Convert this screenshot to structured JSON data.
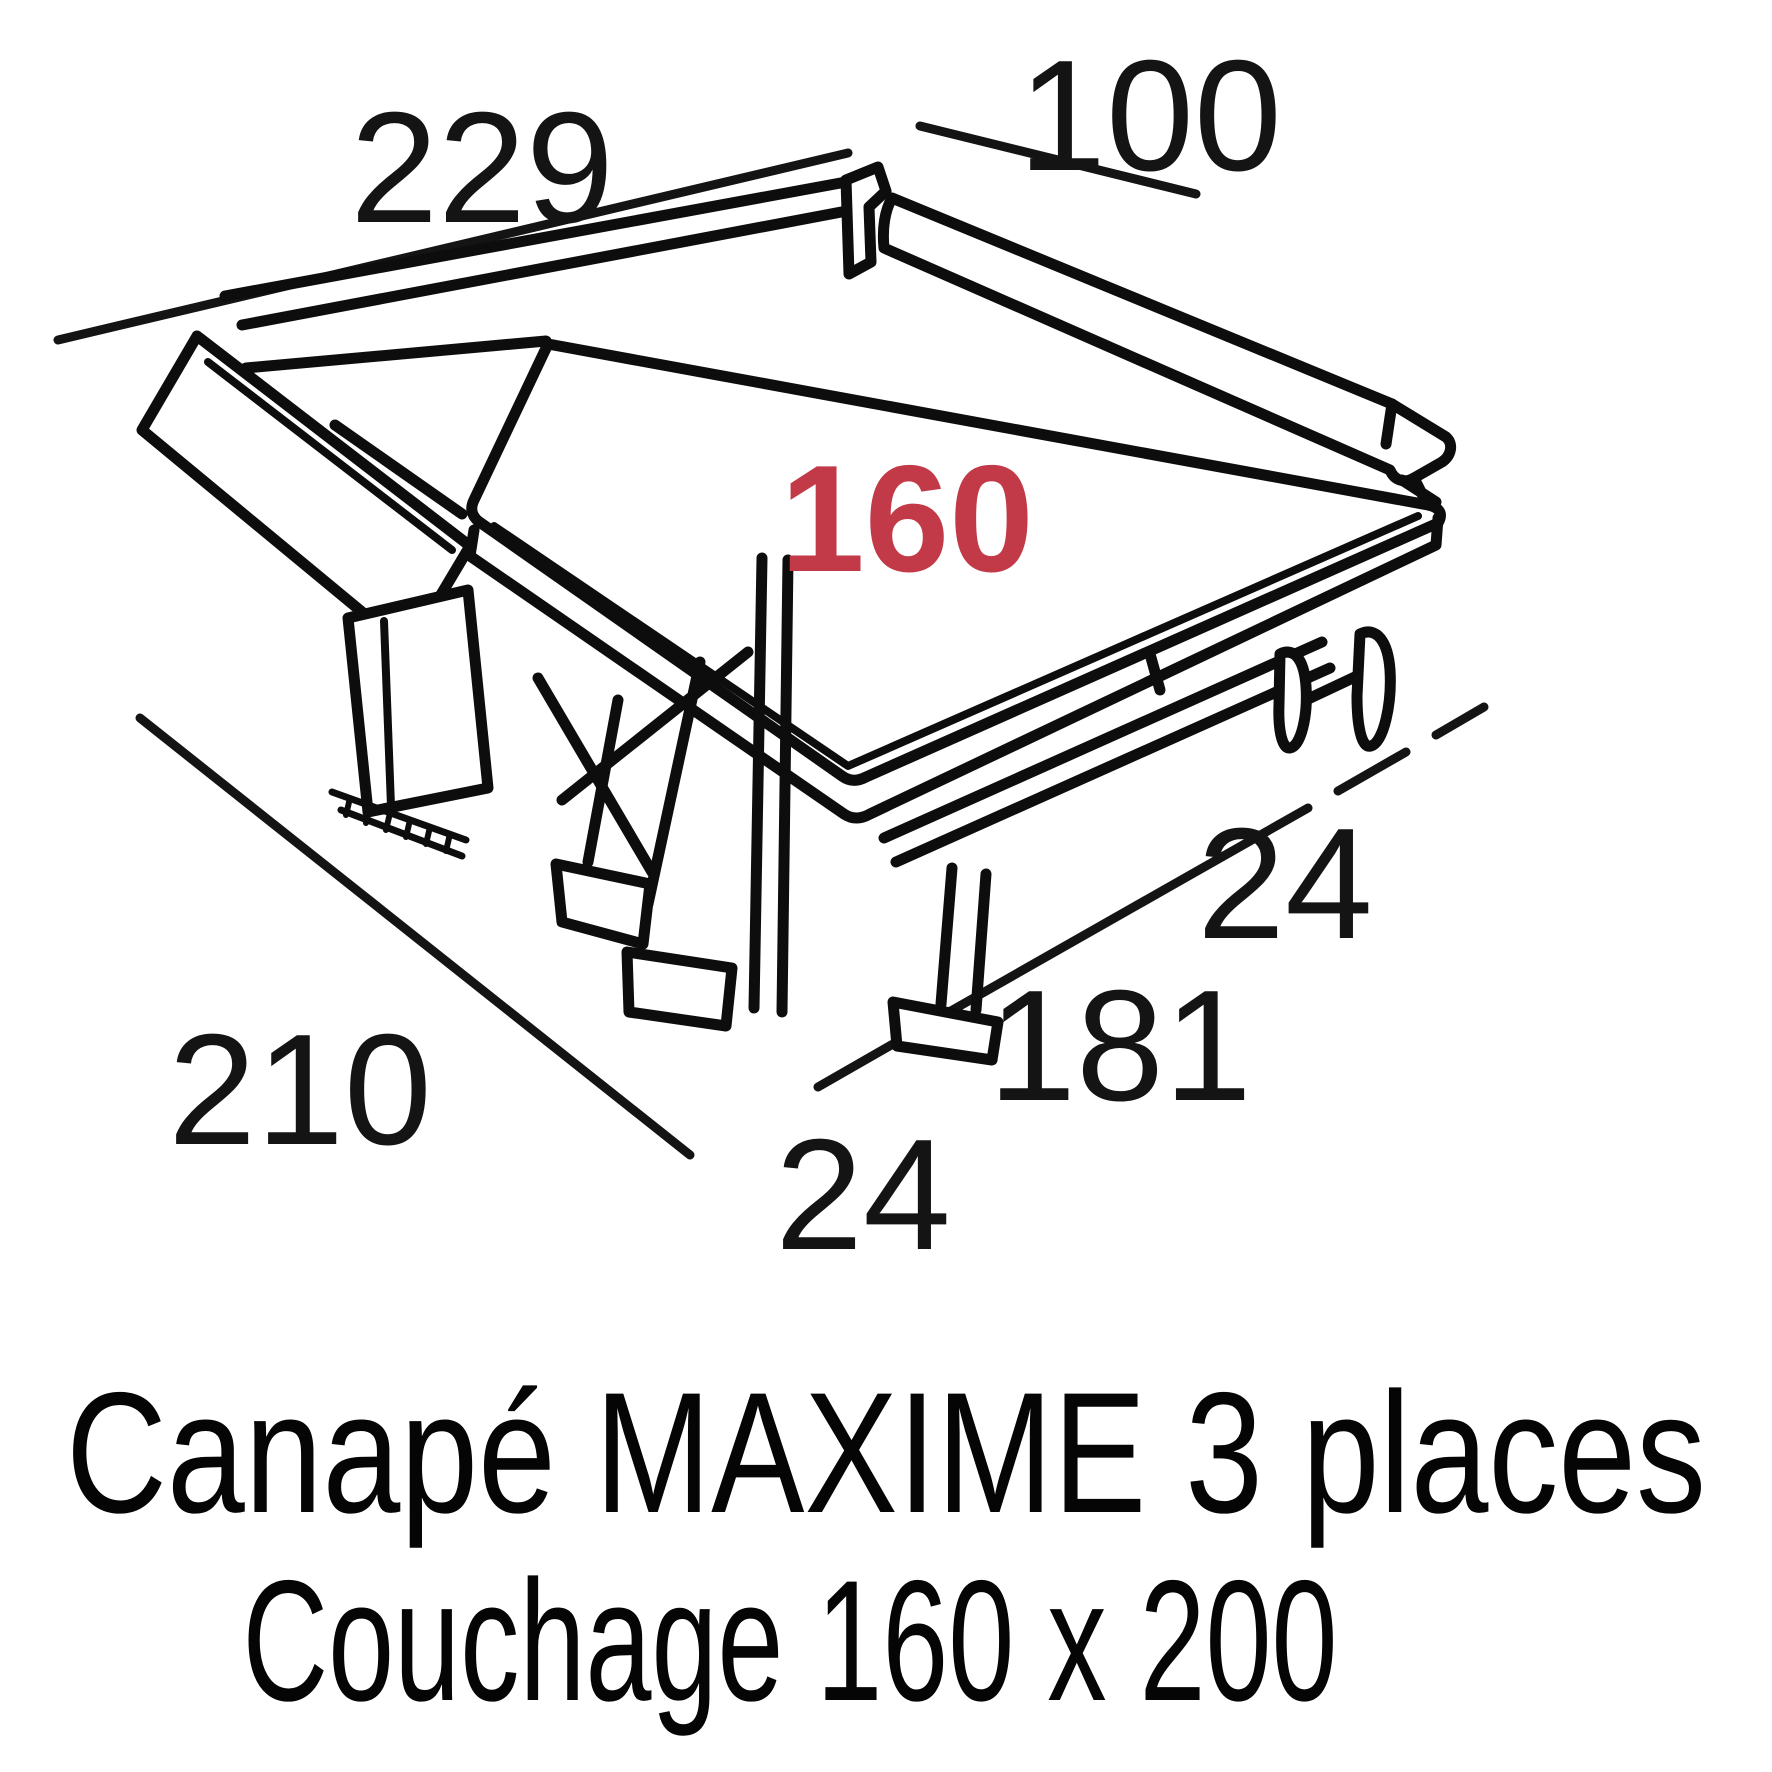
{
  "diagram": {
    "type": "furniture-dimension-drawing",
    "product": "sofa-bed",
    "dimensions": {
      "total_width": "229",
      "backrest_depth": "100",
      "mattress_width": "160",
      "side_offset_right": "24",
      "bed_frame_length": "181",
      "total_depth": "210",
      "front_offset": "24"
    },
    "colors": {
      "highlight_red": "#c23a48",
      "ink": "#141414",
      "background": "#ffffff"
    },
    "title": {
      "line1": "Canapé MAXIME 3 places",
      "line2": "Couchage 160 x 200"
    }
  }
}
